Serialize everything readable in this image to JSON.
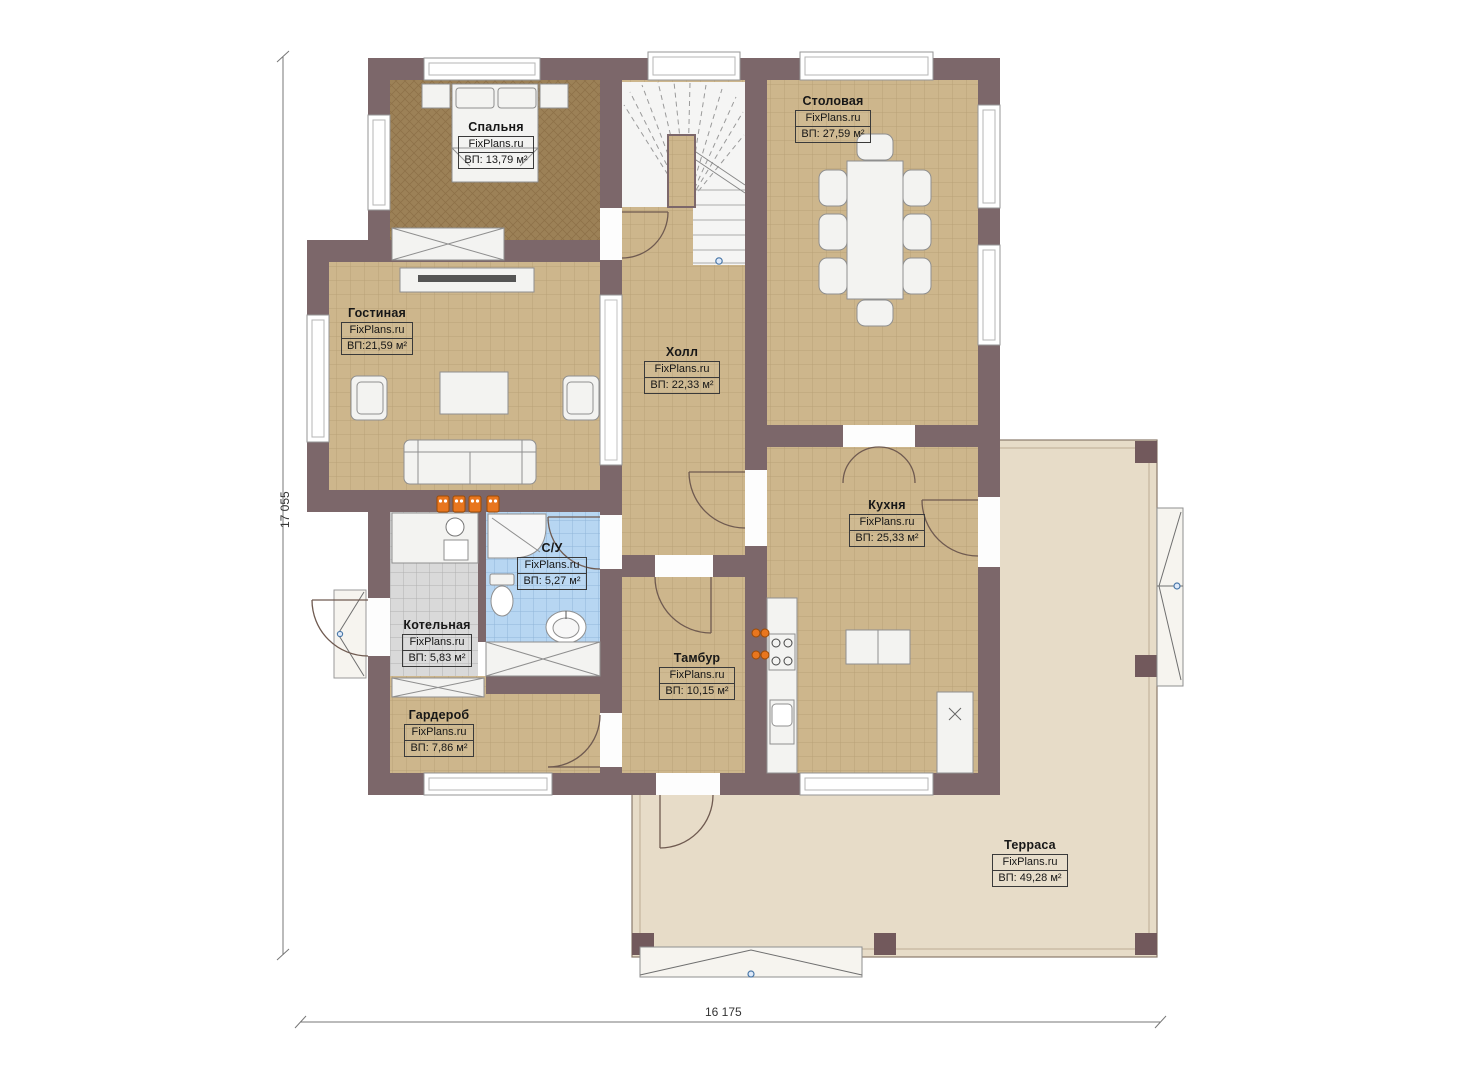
{
  "title": "План первого этажа",
  "brand": "FixPlans.ru",
  "rooms": [
    {
      "id": "bedroom",
      "name": "Спальня",
      "brand": "FixPlans.ru",
      "area": "ВП: 13,79 м²"
    },
    {
      "id": "dining",
      "name": "Столовая",
      "brand": "FixPlans.ru",
      "area": "ВП: 27,59 м²"
    },
    {
      "id": "living",
      "name": "Гостиная",
      "brand": "FixPlans.ru",
      "area": "ВП:21,59 м²"
    },
    {
      "id": "hall",
      "name": "Холл",
      "brand": "FixPlans.ru",
      "area": "ВП: 22,33 м²"
    },
    {
      "id": "kitchen",
      "name": "Кухня",
      "brand": "FixPlans.ru",
      "area": "ВП: 25,33 м²"
    },
    {
      "id": "bathroom",
      "name": "С/У",
      "brand": "FixPlans.ru",
      "area": "ВП: 5,27 м²"
    },
    {
      "id": "boiler",
      "name": "Котельная",
      "brand": "FixPlans.ru",
      "area": "ВП: 5,83 м²"
    },
    {
      "id": "vestibule",
      "name": "Тамбур",
      "brand": "FixPlans.ru",
      "area": "ВП: 10,15 м²"
    },
    {
      "id": "wardrobe",
      "name": "Гардероб",
      "brand": "FixPlans.ru",
      "area": "ВП: 7,86 м²"
    },
    {
      "id": "terrace",
      "name": "Терраса",
      "brand": "FixPlans.ru",
      "area": "ВП: 49,28 м²"
    }
  ],
  "dimensions": {
    "height": "17 055",
    "width": "16 175"
  },
  "colors": {
    "wall": "#7c676a",
    "tile_floor": "#cdb68c",
    "bedroom_carpet": "#9c8157",
    "bathroom_tile": "#b7d6f2",
    "boiler_tile": "#d9d9d9",
    "terrace_deck": "#e7dcc8",
    "accent_orange": "#e8761e",
    "stair_dot_blue": "#4a78a8"
  }
}
